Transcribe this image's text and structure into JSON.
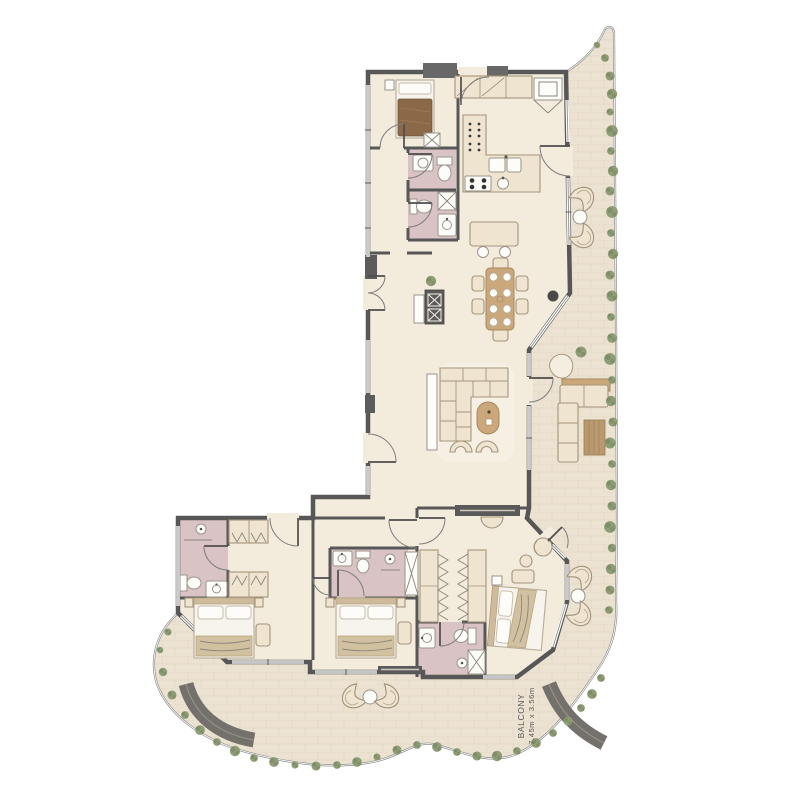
{
  "labels": {
    "balcony": "BALCONY",
    "balcony_dimensions": "7.45m x 3.56m"
  },
  "colors": {
    "wall": "#575757",
    "floor": "#f3ecdd",
    "balcony": "#ece2d1",
    "tile": "#d9cbb4",
    "bath": "#d9c3c4",
    "furn": "#eee4d0",
    "furnline": "#a5947a",
    "wood": "#cba87c",
    "woodline": "#a9885e",
    "plant": "#8f9d76",
    "plantdark": "#71815a",
    "bench": "#74716c",
    "text": "#5a5a5a",
    "blanket": "#8a6848",
    "parapet": "#8f8f8f"
  }
}
